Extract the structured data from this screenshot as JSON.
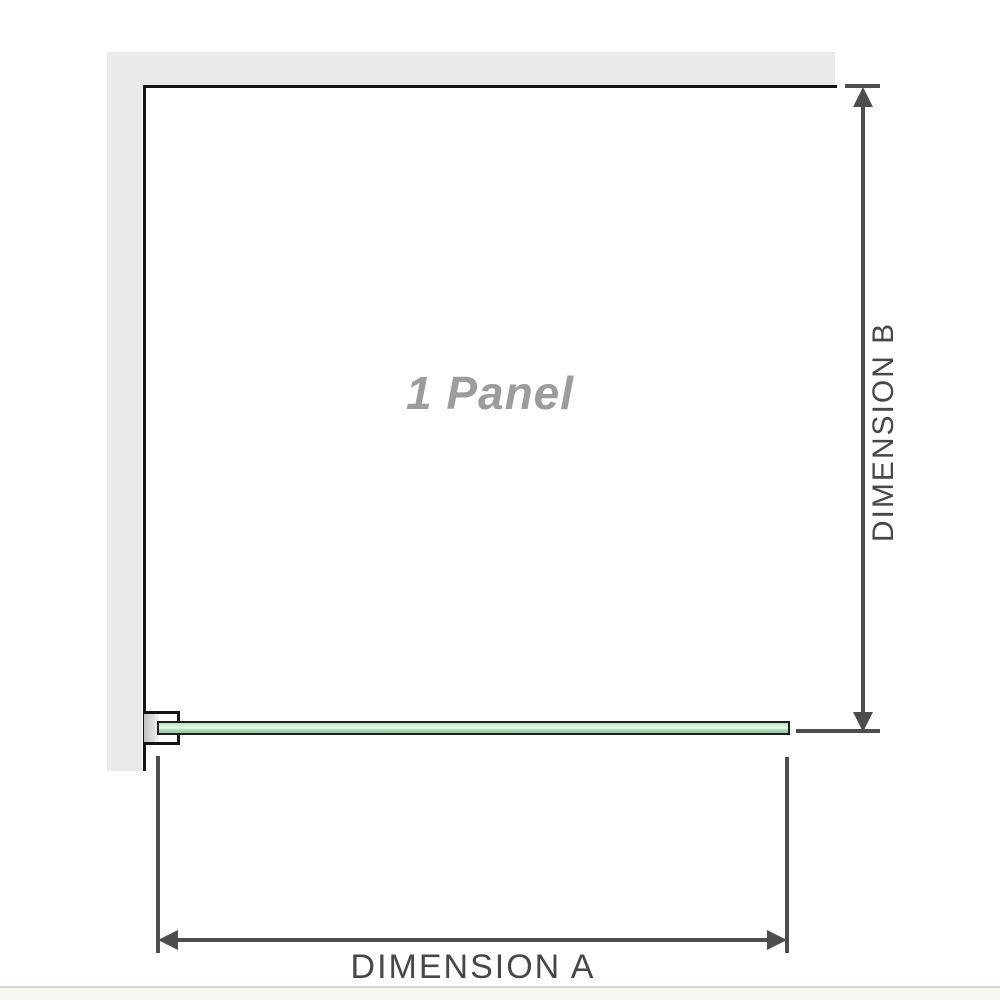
{
  "diagram": {
    "panel_label": "1 Panel",
    "dimension_a_label": "DIMENSION A",
    "dimension_b_label": "DIMENSION B",
    "colors": {
      "wall": "#eaeaea",
      "outline": "#141414",
      "dimension": "#4d4d4d",
      "dim_text": "#45474a",
      "panel_text": "#9c9c9c",
      "glass_light": "#b7e3c4",
      "glass_highlight": "#eaf7ed",
      "glass_mid": "#a6dab4",
      "glass_deep": "#8fcea2",
      "glass_edge": "#1e1e1e",
      "footer_line": "#d9d9d9",
      "footer_bg": "#f7f5f0"
    }
  }
}
